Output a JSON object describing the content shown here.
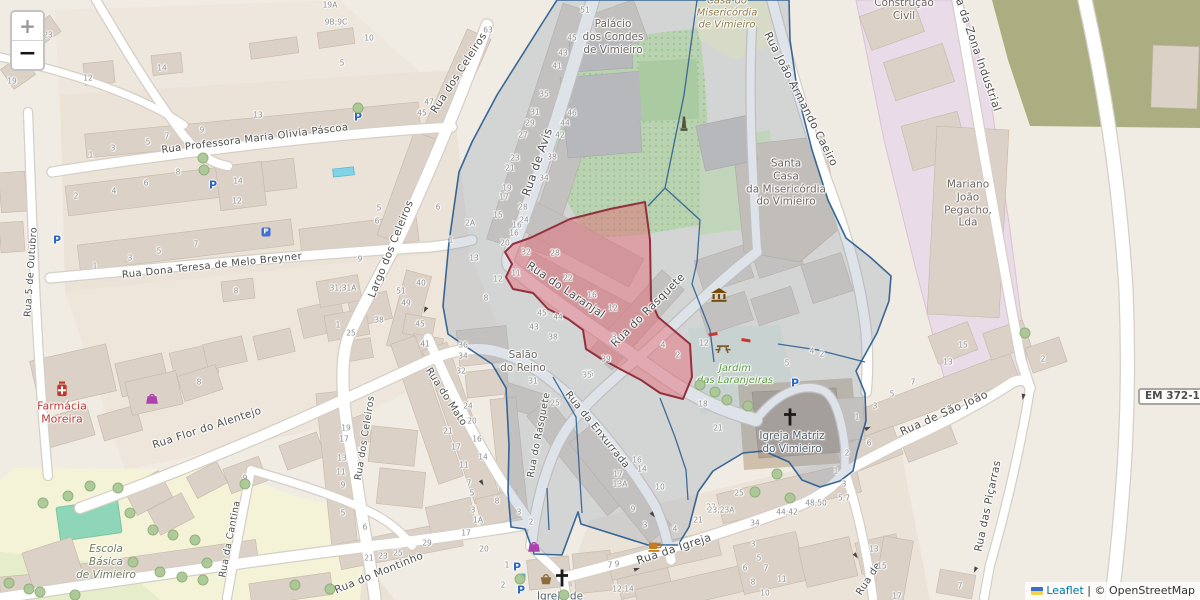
{
  "controls": {
    "zoom_in": "+",
    "zoom_out": "−"
  },
  "attribution": {
    "leaflet": "Leaflet",
    "separator": "|",
    "copyright": "© OpenStreetMap"
  },
  "ref_box": {
    "text": "EM 372-1"
  },
  "colors": {
    "selection_fill": "#e4626c",
    "selection_stroke": "#93303e",
    "parcel_fill": "#7e93ad",
    "parcel_stroke": "#2e5f92",
    "park_green": "#cdeab2",
    "industrial_pink": "#eadbe8",
    "farmland_olive": "#aaae80",
    "school_yellow": "#f5f3d7",
    "pitch_teal": "#8fd6b8",
    "building": "#dbd1c6"
  },
  "street_labels": [
    {
      "t": "Rua Professora Maria Olivia Páscoa",
      "x": 255,
      "y": 139,
      "r": -7,
      "s": 10
    },
    {
      "t": "Rua Dona Teresa de Melo Breyner",
      "x": 212,
      "y": 266,
      "r": -6,
      "s": 10
    },
    {
      "t": "Rua 5 de Outubro",
      "x": 31,
      "y": 272,
      "r": -86,
      "s": 9.5
    },
    {
      "t": "Rua Flor do Alentejo",
      "x": 207,
      "y": 428,
      "r": -18,
      "s": 10.5
    },
    {
      "t": "Largo dos Celeiros",
      "x": 391,
      "y": 249,
      "r": -68,
      "s": 10.5
    },
    {
      "t": "Rua dos Celeiros",
      "x": 459,
      "y": 73,
      "r": -57,
      "s": 10.5
    },
    {
      "t": "Rua dos Celeiros",
      "x": 365,
      "y": 438,
      "r": -81,
      "s": 9.5
    },
    {
      "t": "Rua de Avis",
      "x": 537,
      "y": 162,
      "r": -71,
      "s": 11.5
    },
    {
      "t": "Rua do Laranjal",
      "x": 566,
      "y": 290,
      "r": 34,
      "s": 11
    },
    {
      "t": "Rua do Rasquete",
      "x": 648,
      "y": 310,
      "r": -45,
      "s": 11
    },
    {
      "t": "Rua do Rasquete",
      "x": 539,
      "y": 435,
      "r": -79,
      "s": 9.5
    },
    {
      "t": "Rua da Enxurrada",
      "x": 597,
      "y": 430,
      "r": 51,
      "s": 10
    },
    {
      "t": "Rua do Mato",
      "x": 446,
      "y": 397,
      "r": 57,
      "s": 10
    },
    {
      "t": "Rua do Montinho",
      "x": 379,
      "y": 573,
      "r": -22,
      "s": 10.5
    },
    {
      "t": "Rua da Igreja",
      "x": 674,
      "y": 549,
      "r": -18,
      "s": 11
    },
    {
      "t": "Rua de São João",
      "x": 944,
      "y": 413,
      "r": -24,
      "s": 11
    },
    {
      "t": "Rua das Piçarras",
      "x": 988,
      "y": 506,
      "r": -78,
      "s": 10.5
    },
    {
      "t": "Rua João Armando Caeiro",
      "x": 801,
      "y": 99,
      "r": 63,
      "s": 11
    },
    {
      "t": "Rua da Zona Industrial",
      "x": 976,
      "y": 48,
      "r": 71,
      "s": 11
    },
    {
      "t": "Rua da Cantina",
      "x": 230,
      "y": 539,
      "r": -79,
      "s": 9.5
    },
    {
      "t": "Rua de",
      "x": 869,
      "y": 579,
      "r": -57,
      "s": 10
    }
  ],
  "place_labels": [
    {
      "lines": [
        "Palácio",
        "dos Condes",
        "de Vimieiro"
      ],
      "x": 613,
      "y": 37,
      "c": "#6e6560",
      "i": false,
      "s": 10.5
    },
    {
      "lines": [
        "Casa do",
        "Misericórdia",
        "de Vimieiro"
      ],
      "x": 727,
      "y": 14,
      "c": "#8c7b4b",
      "i": true,
      "s": 10
    },
    {
      "lines": [
        "Santa",
        "Casa",
        "da Misericórdia",
        "do Vimieiro"
      ],
      "x": 786,
      "y": 183,
      "c": "#6e6560",
      "i": false,
      "s": 10.5
    },
    {
      "lines": [
        "Mariano",
        "João",
        "Pegacho,",
        "Lda"
      ],
      "x": 968,
      "y": 204,
      "c": "#6e6560",
      "i": false,
      "s": 10.5
    },
    {
      "lines": [
        "Construção",
        "Civil"
      ],
      "x": 904,
      "y": 10,
      "c": "#6e6560",
      "i": false,
      "s": 10.5
    },
    {
      "lines": [
        "Farmácia",
        "Moreira"
      ],
      "x": 62,
      "y": 413,
      "c": "#bb3a35",
      "i": false,
      "s": 11
    },
    {
      "lines": [
        "Salão",
        "do Reino"
      ],
      "x": 523,
      "y": 362,
      "c": "#6e6560",
      "i": false,
      "s": 10.5
    },
    {
      "lines": [
        "Jardim",
        "das Laranjeiras"
      ],
      "x": 735,
      "y": 375,
      "c": "#579a3f",
      "i": true,
      "s": 10
    },
    {
      "lines": [
        "Igreja Matriz",
        "do Vimieiro"
      ],
      "x": 792,
      "y": 443,
      "c": "#52616b",
      "i": false,
      "s": 10.5
    },
    {
      "lines": [
        "Escola",
        "Básica",
        "de Vimieiro"
      ],
      "x": 106,
      "y": 562,
      "c": "#6f7b5e",
      "i": true,
      "s": 10.5
    },
    {
      "lines": [
        "Igreja de"
      ],
      "x": 560,
      "y": 597,
      "c": "#52616b",
      "i": false,
      "s": 10.5
    }
  ],
  "house_numbers": [
    [
      91,
      155,
      "1"
    ],
    [
      113,
      148,
      "3"
    ],
    [
      148,
      142,
      "5"
    ],
    [
      167,
      136,
      "7"
    ],
    [
      202,
      130,
      "9"
    ],
    [
      76,
      196,
      "2"
    ],
    [
      114,
      191,
      "4"
    ],
    [
      146,
      183,
      "6"
    ],
    [
      178,
      172,
      "8"
    ],
    [
      238,
      181,
      "14"
    ],
    [
      237,
      201,
      "12"
    ],
    [
      95,
      266,
      "1"
    ],
    [
      130,
      258,
      "3"
    ],
    [
      159,
      251,
      "5"
    ],
    [
      196,
      244,
      "7"
    ],
    [
      236,
      291,
      "8"
    ],
    [
      48,
      35,
      "23"
    ],
    [
      12,
      81,
      "19"
    ],
    [
      88,
      78,
      "12"
    ],
    [
      162,
      68,
      "14"
    ],
    [
      330,
      5,
      "19A"
    ],
    [
      336,
      22,
      "9B;9C"
    ],
    [
      369,
      38,
      "10"
    ],
    [
      342,
      63,
      "5"
    ],
    [
      488,
      30,
      "63"
    ],
    [
      429,
      102,
      "47"
    ],
    [
      422,
      113,
      "45"
    ],
    [
      258,
      115,
      "13"
    ],
    [
      585,
      10,
      "51"
    ],
    [
      572,
      38,
      "45"
    ],
    [
      563,
      53,
      "43"
    ],
    [
      557,
      66,
      "41"
    ],
    [
      544,
      94,
      "35"
    ],
    [
      535,
      112,
      "31"
    ],
    [
      530,
      123,
      "29"
    ],
    [
      523,
      135,
      "27"
    ],
    [
      515,
      158,
      "23"
    ],
    [
      510,
      168,
      "21"
    ],
    [
      507,
      188,
      "19"
    ],
    [
      504,
      197,
      "17"
    ],
    [
      498,
      215,
      "15"
    ],
    [
      572,
      113,
      "46"
    ],
    [
      565,
      123,
      "44"
    ],
    [
      560,
      135,
      "42"
    ],
    [
      552,
      157,
      "38"
    ],
    [
      544,
      178,
      "34"
    ],
    [
      523,
      207,
      "28"
    ],
    [
      524,
      220,
      "24"
    ],
    [
      514,
      233,
      "16"
    ],
    [
      438,
      207,
      "6"
    ],
    [
      470,
      223,
      "2A"
    ],
    [
      379,
      208,
      "5"
    ],
    [
      377,
      221,
      "6"
    ],
    [
      360,
      259,
      "9"
    ],
    [
      343,
      288,
      "31;31A"
    ],
    [
      338,
      325,
      "1"
    ],
    [
      351,
      333,
      "25"
    ],
    [
      379,
      320,
      "38"
    ],
    [
      401,
      291,
      "51"
    ],
    [
      406,
      303,
      "49"
    ],
    [
      420,
      324,
      "45"
    ],
    [
      425,
      344,
      "41"
    ],
    [
      421,
      283,
      "40"
    ],
    [
      451,
      240,
      "1"
    ],
    [
      474,
      258,
      "13"
    ],
    [
      505,
      243,
      "20"
    ],
    [
      517,
      225,
      "16"
    ],
    [
      526,
      252,
      "32"
    ],
    [
      555,
      253,
      "28"
    ],
    [
      568,
      278,
      "22"
    ],
    [
      592,
      295,
      "16"
    ],
    [
      613,
      308,
      "12"
    ],
    [
      516,
      273,
      "11"
    ],
    [
      498,
      279,
      "12"
    ],
    [
      486,
      298,
      "8"
    ],
    [
      542,
      313,
      "45"
    ],
    [
      558,
      317,
      "44"
    ],
    [
      534,
      327,
      "43"
    ],
    [
      553,
      337,
      "38"
    ],
    [
      606,
      359,
      "39"
    ],
    [
      589,
      374,
      "35"
    ],
    [
      533,
      381,
      "31"
    ],
    [
      614,
      337,
      "3"
    ],
    [
      663,
      345,
      "4"
    ],
    [
      678,
      355,
      "2"
    ],
    [
      704,
      343,
      "12"
    ],
    [
      703,
      404,
      "18"
    ],
    [
      718,
      428,
      "21"
    ],
    [
      787,
      363,
      "5"
    ],
    [
      812,
      351,
      "4"
    ],
    [
      822,
      354,
      "2"
    ],
    [
      857,
      417,
      "1"
    ],
    [
      875,
      406,
      "3"
    ],
    [
      892,
      394,
      "5"
    ],
    [
      913,
      382,
      "7"
    ],
    [
      847,
      453,
      "2"
    ],
    [
      869,
      443,
      "6"
    ],
    [
      963,
      345,
      "15"
    ],
    [
      948,
      362,
      "13"
    ],
    [
      1043,
      359,
      "2"
    ],
    [
      463,
      345,
      "36"
    ],
    [
      463,
      356,
      "34"
    ],
    [
      461,
      371,
      "32"
    ],
    [
      468,
      406,
      "24"
    ],
    [
      472,
      421,
      "20"
    ],
    [
      448,
      431,
      "21"
    ],
    [
      477,
      439,
      "16"
    ],
    [
      456,
      447,
      "17"
    ],
    [
      483,
      457,
      "14"
    ],
    [
      464,
      465,
      "11"
    ],
    [
      469,
      483,
      "7"
    ],
    [
      472,
      493,
      "5"
    ],
    [
      473,
      510,
      "3"
    ],
    [
      478,
      520,
      "1A"
    ],
    [
      497,
      501,
      "8"
    ],
    [
      346,
      428,
      "19"
    ],
    [
      344,
      439,
      "17"
    ],
    [
      342,
      458,
      "13"
    ],
    [
      341,
      472,
      "11"
    ],
    [
      343,
      485,
      "9"
    ],
    [
      343,
      513,
      "5"
    ],
    [
      365,
      527,
      "6"
    ],
    [
      587,
      375,
      "35"
    ],
    [
      555,
      403,
      "25"
    ],
    [
      637,
      460,
      "16"
    ],
    [
      642,
      469,
      "14"
    ],
    [
      618,
      474,
      "17"
    ],
    [
      620,
      484,
      "13A"
    ],
    [
      660,
      487,
      "10"
    ],
    [
      633,
      509,
      "9"
    ],
    [
      645,
      525,
      "3"
    ],
    [
      675,
      529,
      "4"
    ],
    [
      698,
      520,
      "21"
    ],
    [
      711,
      507,
      "23"
    ],
    [
      369,
      558,
      "21"
    ],
    [
      383,
      556,
      "23"
    ],
    [
      398,
      553,
      "25"
    ],
    [
      427,
      543,
      "29"
    ],
    [
      466,
      533,
      "17"
    ],
    [
      484,
      549,
      "20"
    ],
    [
      519,
      512,
      "3"
    ],
    [
      531,
      522,
      "2"
    ],
    [
      507,
      565,
      "1"
    ],
    [
      503,
      585,
      "2"
    ],
    [
      610,
      565,
      "7"
    ],
    [
      617,
      564,
      "9"
    ],
    [
      623,
      589,
      "12;14"
    ],
    [
      739,
      493,
      "25"
    ],
    [
      721,
      510,
      "23;23A"
    ],
    [
      787,
      512,
      "44;42"
    ],
    [
      816,
      503,
      "48;50"
    ],
    [
      844,
      498,
      "5;7"
    ],
    [
      755,
      523,
      "34"
    ],
    [
      753,
      544,
      "3"
    ],
    [
      759,
      558,
      "5"
    ],
    [
      745,
      568,
      "6"
    ],
    [
      766,
      568,
      "7"
    ],
    [
      753,
      582,
      "8"
    ],
    [
      782,
      579,
      "11"
    ],
    [
      765,
      593,
      "10"
    ],
    [
      874,
      549,
      "13"
    ],
    [
      882,
      566,
      "15"
    ],
    [
      897,
      596,
      "17"
    ],
    [
      836,
      471,
      "1"
    ],
    [
      844,
      484,
      "3"
    ],
    [
      960,
      586,
      "7"
    ],
    [
      199,
      382,
      "8"
    ],
    [
      245,
      478,
      "9"
    ]
  ],
  "icons": [
    {
      "n": "parking-icon",
      "k": "p",
      "x": 57,
      "y": 240
    },
    {
      "n": "parking-icon",
      "k": "p",
      "x": 213,
      "y": 185
    },
    {
      "n": "parking-icon",
      "k": "p",
      "x": 358,
      "y": 117
    },
    {
      "n": "parking-icon",
      "k": "p",
      "x": 795,
      "y": 383
    },
    {
      "n": "parking-icon",
      "k": "p",
      "x": 517,
      "y": 567
    },
    {
      "n": "parking-icon",
      "k": "p",
      "x": 521,
      "y": 590
    },
    {
      "n": "parking-area-icon",
      "k": "pfill",
      "x": 266,
      "y": 232
    },
    {
      "n": "museum-icon",
      "k": "museum",
      "x": 719,
      "y": 295
    },
    {
      "n": "monument-icon",
      "k": "monument",
      "x": 684,
      "y": 124
    },
    {
      "n": "church-cross-icon",
      "k": "cross",
      "x": 790,
      "y": 417
    },
    {
      "n": "church-cross-icon",
      "k": "cross",
      "x": 562,
      "y": 578
    },
    {
      "n": "pharmacy-icon",
      "k": "pharmacy",
      "x": 62,
      "y": 389
    },
    {
      "n": "clothes-shop-icon",
      "k": "shop",
      "x": 152,
      "y": 398
    },
    {
      "n": "clothes-shop-icon",
      "k": "shop",
      "x": 534,
      "y": 546
    },
    {
      "n": "cafe-icon",
      "k": "cafe",
      "x": 655,
      "y": 547
    },
    {
      "n": "basket-icon",
      "k": "basket",
      "x": 546,
      "y": 579
    },
    {
      "n": "picnic-icon",
      "k": "picnic",
      "x": 723,
      "y": 348
    },
    {
      "n": "drinking-water-icon",
      "k": "water",
      "x": 523,
      "y": 576
    },
    {
      "n": "barrier-icon",
      "k": "barrier",
      "x": 713,
      "y": 334,
      "r": 80
    },
    {
      "n": "barrier-icon",
      "k": "barrier",
      "x": 746,
      "y": 340,
      "r": 100
    },
    {
      "n": "oneway-arrow-icon",
      "k": "arrow",
      "x": 637,
      "y": 569,
      "r": -18
    },
    {
      "n": "oneway-arrow-icon",
      "k": "arrow",
      "x": 868,
      "y": 428,
      "r": -24
    },
    {
      "n": "oneway-arrow-icon",
      "k": "arrow",
      "x": 1023,
      "y": 397,
      "r": 100
    },
    {
      "n": "oneway-arrow-icon",
      "k": "arrow",
      "x": 975,
      "y": 570,
      "r": 115
    },
    {
      "n": "oneway-arrow-icon",
      "k": "arrow",
      "x": 482,
      "y": 483,
      "r": 62
    },
    {
      "n": "oneway-arrow-icon",
      "k": "arrow",
      "x": 653,
      "y": 515,
      "r": 52
    },
    {
      "n": "oneway-arrow-icon",
      "k": "arrow",
      "x": 425,
      "y": 310,
      "r": 117
    },
    {
      "n": "oneway-arrow-icon",
      "k": "arrow",
      "x": 856,
      "y": 556,
      "r": 55
    }
  ],
  "trees": [
    [
      68,
      496
    ],
    [
      43,
      503
    ],
    [
      90,
      486
    ],
    [
      118,
      488
    ],
    [
      130,
      513
    ],
    [
      153,
      530
    ],
    [
      173,
      535
    ],
    [
      195,
      540
    ],
    [
      207,
      563
    ],
    [
      203,
      580
    ],
    [
      182,
      577
    ],
    [
      160,
      572
    ],
    [
      133,
      562
    ],
    [
      29,
      589
    ],
    [
      9,
      583
    ],
    [
      245,
      484
    ],
    [
      75,
      595
    ],
    [
      40,
      592
    ],
    [
      295,
      585
    ],
    [
      330,
      589
    ],
    [
      715,
      392
    ],
    [
      727,
      400
    ],
    [
      700,
      385
    ],
    [
      748,
      406
    ],
    [
      520,
      579
    ],
    [
      564,
      595
    ],
    [
      755,
      492
    ],
    [
      790,
      498
    ],
    [
      777,
      474
    ],
    [
      203,
      158
    ],
    [
      204,
      170
    ],
    [
      358,
      108
    ],
    [
      1025,
      333
    ]
  ]
}
